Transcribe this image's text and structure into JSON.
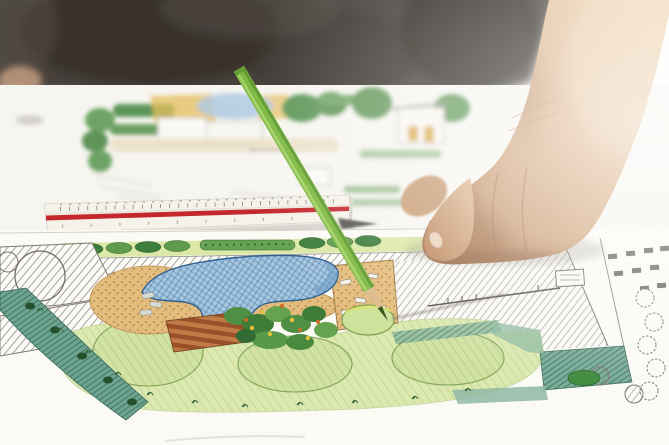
{
  "scene": {
    "description": "Close-up photo: a hand holding a green colored pencil over a hand-drawn backyard landscape architecture plan; a white triangular scale ruler with a red stripe lies on the paper; a second faded landscape plan sheet sits out of focus in the background below a dark shirt.",
    "visible_text": [],
    "objects": [
      "person-shirt",
      "forearm",
      "hand",
      "index-finger",
      "fingernail",
      "green-colored-pencil",
      "pencil-wood-cone",
      "pencil-lead-tip",
      "triangular-scale-ruler",
      "ruler-red-stripe",
      "ruler-tick-marks",
      "background-plan-sheet",
      "background-house-elevation",
      "background-pond",
      "main-plan-sheet",
      "tree-row",
      "driveway-hatch",
      "roof-hatch",
      "tree-canopy-circle",
      "pond",
      "waterfall-stones",
      "wood-deck",
      "shrub-cluster",
      "gravel-patio",
      "stepping-stones",
      "lawn",
      "lawn-mounds",
      "groundcover-border",
      "patio-hatch-right",
      "wall-line",
      "furniture-symbol",
      "tree-symbol-circles",
      "shrub-ellipse",
      "pencil-shadow",
      "hand-shadow"
    ]
  },
  "colors": {
    "shirt": "#47413b",
    "shirt_dark": "#322d28",
    "paper_bg": "#f6f5f0",
    "plan_paper": "#fbfaf5",
    "skin_mid": "#c99e76",
    "pencil_body": "#7cb93f",
    "pencil_wood": "#dcbb8a",
    "pencil_lead": "#32511d",
    "ruler_body": "#f5f2e9",
    "ruler_stripe": "#c4272c",
    "pond": "#a6c6df",
    "pond_line": "#2e6090",
    "lawn": "#dbe8af",
    "lawn_mound": "#d2e2a2",
    "tree_dark": "#3c7c3c",
    "tree_mid": "#5f9b4f",
    "hedge": "#67a354",
    "shrub_yellow": "#e6c23a",
    "shrub_orange": "#cf6a2a",
    "gravel": "#e3bd7e",
    "deck": "#c07a45",
    "deck_dark": "#9a4f28",
    "teal": "#6fa491",
    "teal_light": "#8fb8a4",
    "line_work": "#8a877e"
  }
}
